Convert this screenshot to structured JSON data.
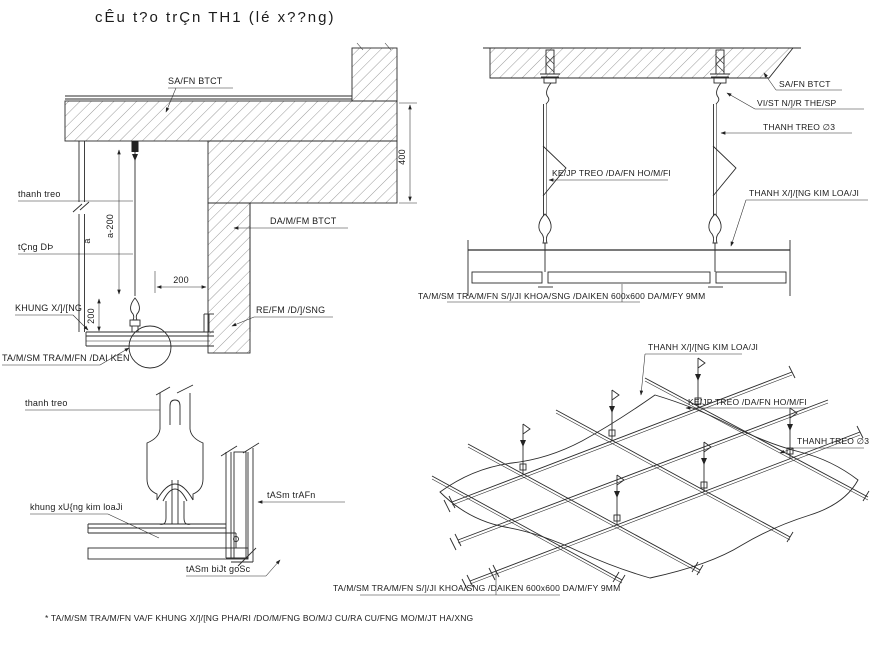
{
  "title": "cÊu t?o trÇn TH1 (lé x??ng)",
  "footnote": "* TA/M/SM TRA/M/FN VA/F KHUNG X/]/[NG PHA/RI /DO/M/FNG BO/M/J CU/RA CU/FNG MO/M/JT HA/XNG",
  "colors": {
    "background": "#ffffff",
    "line": "#2b2b2b",
    "text": "#1b1b1b"
  },
  "section": {
    "slab_label": "SA/FN BTCT",
    "hanger_label": "thanh treo",
    "level_label": "tÇng DÞ",
    "frame_label": "KHUNG X/]/[NG",
    "panel_label": "TA/M/SM TRA/M/FN /DAI KEN",
    "edge_label": "RE/FM /D/]/SNG",
    "beam_label": "DA/M/FM BTCT",
    "dim_depth": "400",
    "dim_wire": "a-200",
    "dim_a": "a",
    "dim_offset_h": "200",
    "dim_offset_v": "200"
  },
  "elevation": {
    "slab_label": "SA/FN BTCT",
    "anchor_label": "VI/ST N/]/R THE/SP",
    "rod_label": "THANH TREO ∅3",
    "clip_label": "KE/JP TREO /DA/FN HO/M/FI",
    "runner_label": "THANH X/]/[NG KIM LOA/JI",
    "panel_label": "TA/M/SM TRA/M/FN S/]/JI KHOA/SNG /DAIKEN 600x600 DA/M/FY 9MM"
  },
  "corner": {
    "hanger_label": "thanh treo",
    "frame_label": "khung xU{ng kim loaJi",
    "panel_label": "tASm trAFn",
    "corner_label": "tASm biJt goSc"
  },
  "iso": {
    "runner_label": "THANH X/]/[NG KIM LOA/JI",
    "clip_label": "KE/JP TREO /DA/FN HO/M/FI",
    "rod_label": "THANH TREO ∅3",
    "panel_label": "TA/M/SM TRA/M/FN S/]/JI KHOA/SNG /DAIKEN 600x600 DA/M/FY 9MM"
  }
}
